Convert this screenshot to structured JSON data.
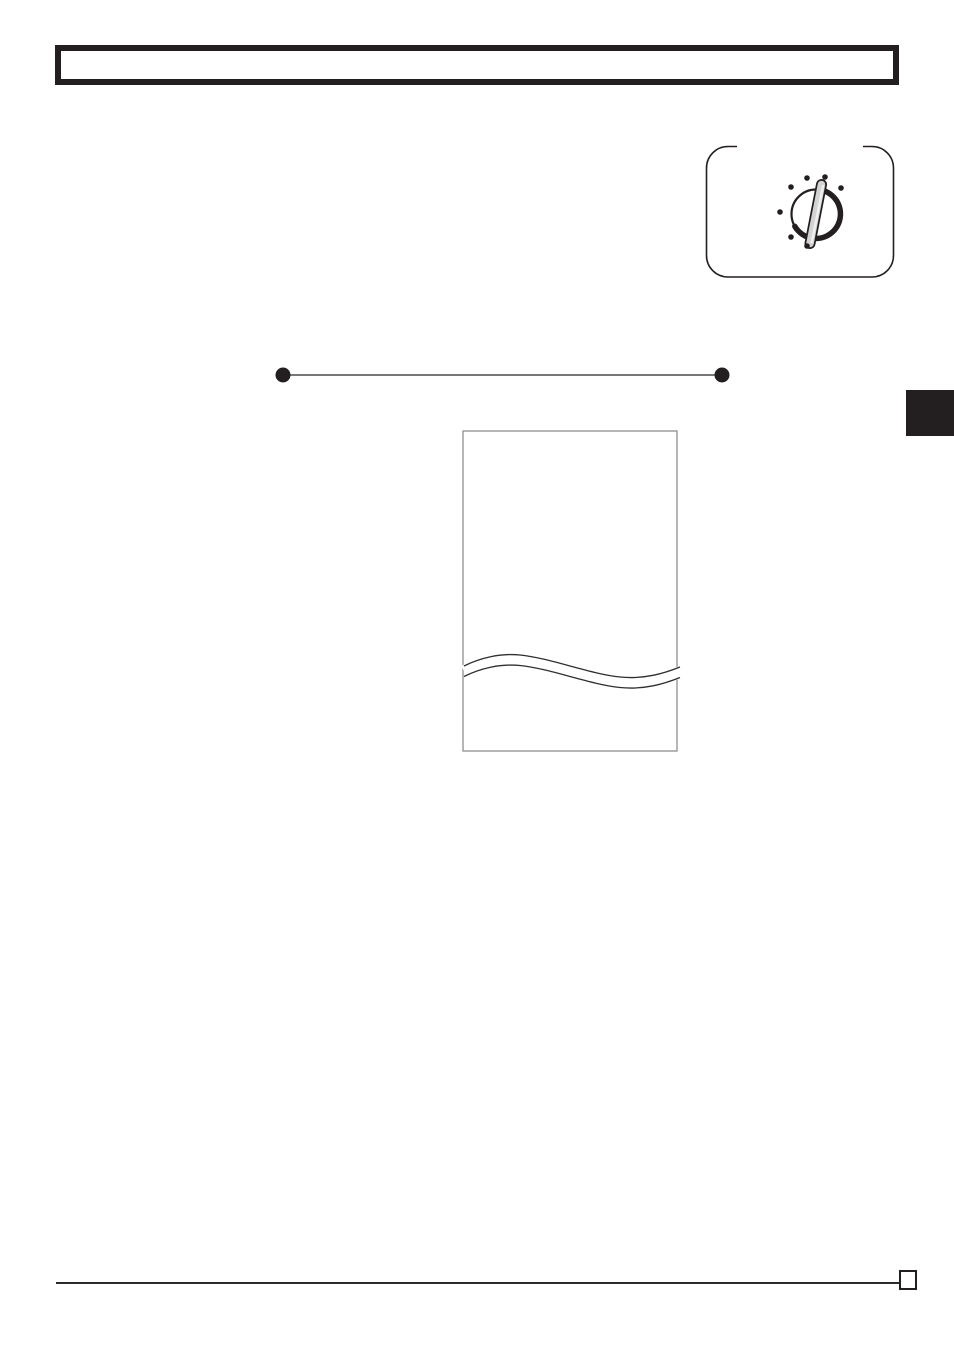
{
  "colors": {
    "ink": "#231f20",
    "page_bg": "#ffffff",
    "figure_border": "#8f8f8f",
    "wave_line": "#2f2f2f",
    "divider_line": "#4a4a4a",
    "rule": "#2b2b2b",
    "knob_fill": "#d3d3d3",
    "knob_highlight": "#efefef"
  },
  "header_box": {
    "text": ""
  },
  "dial_panel": {
    "frame_path": "M 32 1.5 L 23 1.5 A 21.5 21.5 0 0 0 1.5 23 L 1.5 110.5 A 21.5 21.5 0 0 0 23 132 L 167 132 A 21.5 21.5 0 0 0 188.5 110.5 L 188.5 23 A 21.5 21.5 0 0 0 167 1.5 L 158 1.5",
    "circle": {
      "cx": "111",
      "cy": "69",
      "r": "24.5"
    },
    "crescent_path": "M 117.3 45.3 A 24.5 24.5 0 1 1 89.8 81.3",
    "knob": {
      "x1": "116.5",
      "y1": "39.5",
      "x2": "105",
      "y2": "98.5"
    },
    "knob_shine": {
      "x1": "118",
      "y1": "41",
      "x2": "106.8",
      "y2": "97"
    },
    "dot_radius": "2.8",
    "dots": [
      {
        "cx": "86",
        "cy": "42"
      },
      {
        "cx": "102",
        "cy": "33"
      },
      {
        "cx": "120",
        "cy": "32"
      },
      {
        "cx": "136",
        "cy": "43"
      },
      {
        "cx": "75",
        "cy": "67"
      },
      {
        "cx": "86",
        "cy": "92"
      },
      {
        "cx": "102",
        "cy": "101"
      }
    ]
  },
  "bullet_divider": {
    "line": {
      "x1": "13",
      "y1": "10",
      "x2": "452",
      "y2": "10"
    },
    "dot_radius": "7.5",
    "left_dot": {
      "cx": "13",
      "cy": "10"
    },
    "right_dot": {
      "cx": "452",
      "cy": "10"
    }
  },
  "torn_page": {
    "rect": {
      "x": "8",
      "y": "11",
      "width": "214",
      "height": "320"
    },
    "eraser_path": "M 9 251.2 C 25 243.2 45 238.2 65 240.2 C 95 243.2 135 259.2 165 262.2 C 190 264.7 210 258.2 225 252.2",
    "wave_upper_path": "M 9 246 C 25 238 45 233 65 235 C 95 238 135 254 165 257 C 190 259.5 210 253 225 247",
    "wave_lower_path": "M 9 256.5 C 25 248.5 45 243.5 65 245.5 C 95 248.5 135 264.5 165 267.5 C 190 270 210 263.5 225 257.5"
  },
  "footer": {
    "page_number": ""
  }
}
